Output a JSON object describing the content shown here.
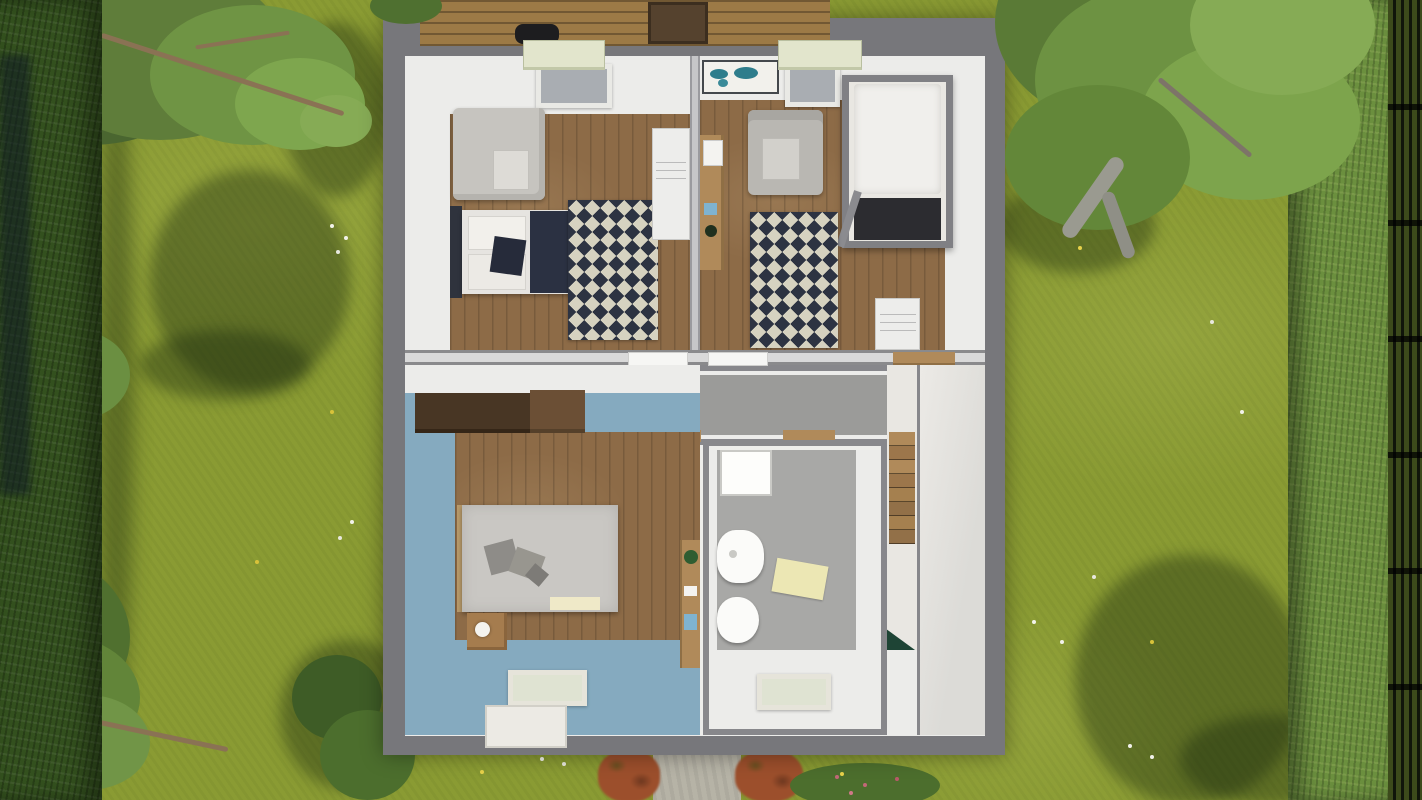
{
  "scene": {
    "description": "Top-down 3D dollhouse render of an upper floor of a house set in a garden",
    "view": "aerial cutaway, roof removed",
    "visible_text": "none"
  },
  "house": {
    "rooms": [
      {
        "name": "bedroom-top-left",
        "floor": "wood",
        "furniture": [
          "roof-dormer",
          "skylight",
          "gray-sofa",
          "double-bed-navy-duvet",
          "zigzag-rug",
          "white-dresser"
        ]
      },
      {
        "name": "kids-room-top-right",
        "floor": "wood",
        "furniture": [
          "world-map-poster",
          "roof-dormer",
          "skylight",
          "gray-armchair",
          "wall-desk",
          "loft-bed-white-mattress",
          "zigzag-rug",
          "white-dresser"
        ]
      },
      {
        "name": "hallway",
        "floor": "gray-carpet",
        "furniture": [
          "door-top-left",
          "door-top-right",
          "threshold-left",
          "threshold-right"
        ]
      },
      {
        "name": "master-bedroom",
        "floor": "wood-with-blue-border",
        "furniture": [
          "dark-wardrobe",
          "wood-shelf",
          "double-bed-gray",
          "pillows",
          "nightstand-with-lamp",
          "skylight",
          "roof-dormer-bottom",
          "vanity-desk",
          "potted-plant"
        ]
      },
      {
        "name": "bathroom",
        "floor": "gray",
        "furniture": [
          "shower",
          "washbasin",
          "toilet",
          "bath-mat",
          "skylight"
        ]
      },
      {
        "name": "stairwell",
        "furniture": [
          "wood-staircase",
          "stair-head-rail",
          "green-plant-corner"
        ]
      },
      {
        "name": "landing",
        "floor": "light"
      }
    ]
  },
  "garden": {
    "elements": [
      "mottled-lawn",
      "left-hedge",
      "right-hedge",
      "dark-fence-right",
      "tree-top-left",
      "tree-mid-left",
      "tree-top-right",
      "tree-shadows",
      "wood-deck-top",
      "grill",
      "planter-box",
      "walkway-bottom",
      "red-bushes",
      "green-bushes",
      "white-flowers",
      "yellow-flowers"
    ]
  },
  "colors": {
    "lawn": "#8a9b33",
    "hedge-left": "#33501e",
    "hedge-right": "#6b8f3e",
    "canopy": "#5f7d3a",
    "canopy-dark": "#4a6630",
    "canopy-light": "#86ab55",
    "branch": "#8a7254",
    "trunk": "#9a9a90",
    "shadow": "rgba(22,38,12,0.38)",
    "roof": "#77777b",
    "wall": "#ececea",
    "wood": "#8d6b47",
    "hall-floor": "#9b9b99",
    "blue-floor": "#85aabf",
    "bath-floor": "#a8a8a6",
    "landing": "#e2e1de",
    "stair-bg": "#e9e7e2",
    "rug-navy": "#2d3342",
    "rug-cream": "#d6d2c0",
    "bed-navy": "#2b3142",
    "sofa": "#c6c4bf",
    "mattress": "#e6e4e0",
    "gray-bed": "#c9c7c3",
    "wardrobe": "#483624",
    "wood-furn": "#b08a5a",
    "dresser": "#ededeb",
    "deck": "#9c7a46",
    "grill": "#1d1d1f",
    "box-brown": "#55422e",
    "dormer": "#e2e5cc",
    "glass": "#a9adb2",
    "glass-pale": "#dfe3d2",
    "path": "#b6b3a6",
    "bush-red": "#9c4f2c",
    "plant": "#2f5d31",
    "tri-green": "#1e4435",
    "mat": "#ece7b4",
    "map-land": "#2e7d8c"
  }
}
